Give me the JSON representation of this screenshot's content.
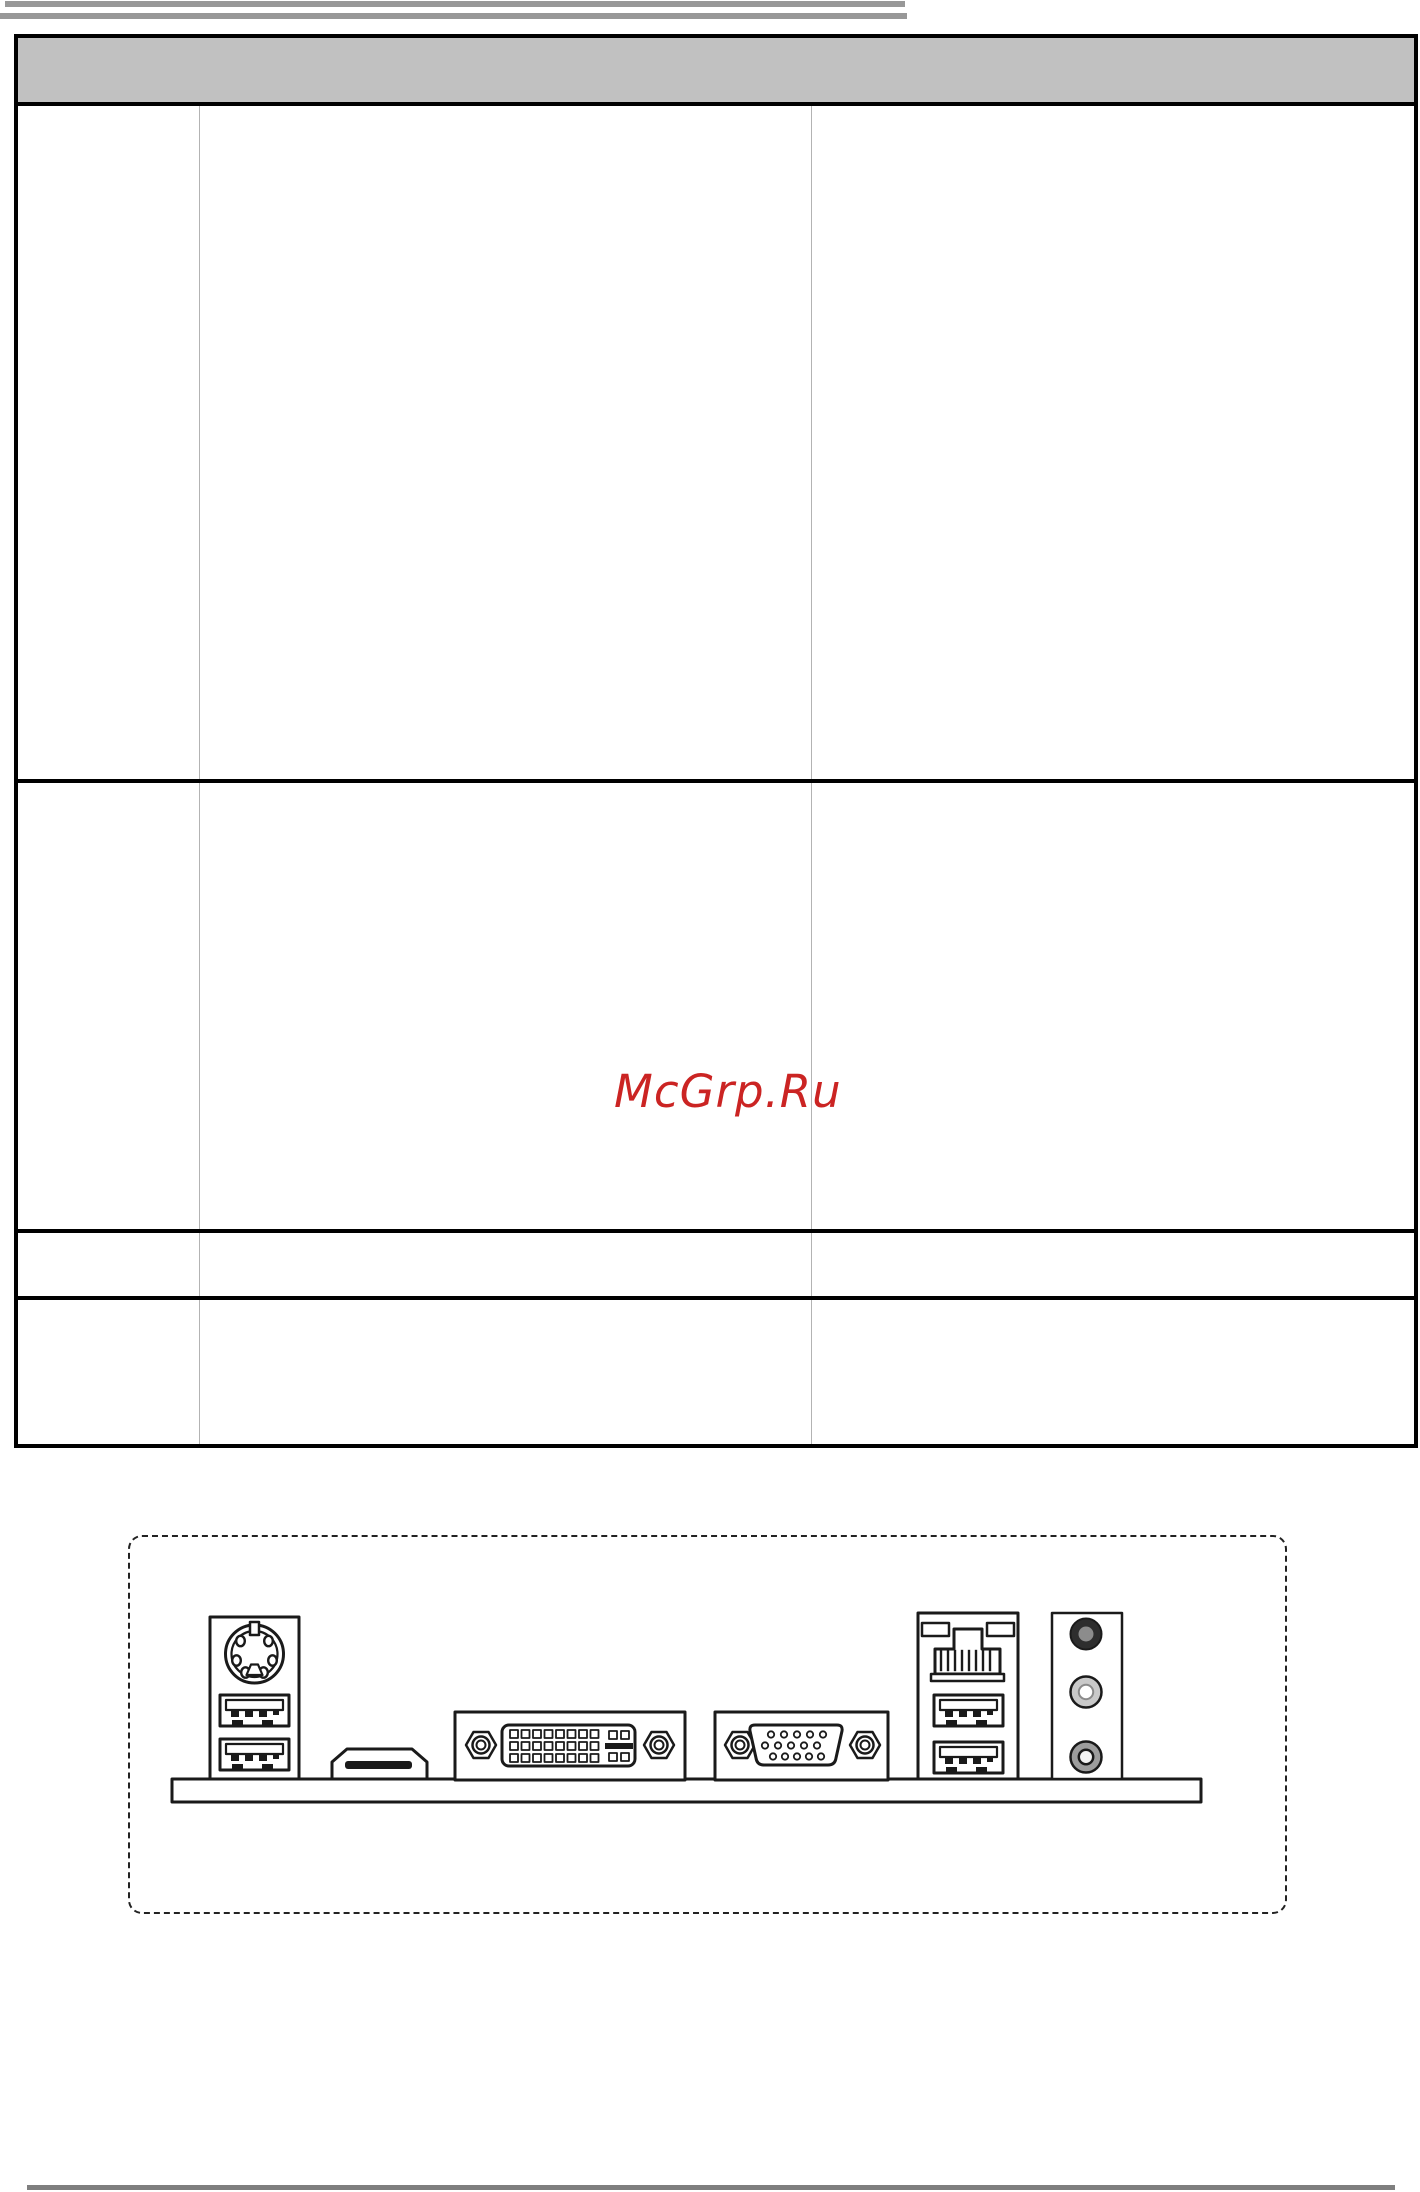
{
  "page": {
    "background": "#ffffff",
    "top_bars_color": "#989898",
    "bottom_bar_color": "#7f7f7f"
  },
  "watermark": {
    "text": "McGrp.Ru",
    "color": "#cb2423"
  },
  "spec_table": {
    "header_fill": "#c1c1c1",
    "border_color": "#000000",
    "divider_color": "#b3b3b3",
    "header_text": "",
    "columns": [
      {
        "text": ""
      },
      {
        "text": ""
      },
      {
        "text": ""
      }
    ],
    "rows": [
      {
        "cells": [
          "",
          "",
          ""
        ]
      },
      {
        "cells": [
          "",
          "",
          ""
        ]
      },
      {
        "cells": [
          "",
          "",
          ""
        ]
      },
      {
        "cells": [
          "",
          "",
          ""
        ]
      }
    ]
  },
  "io_panel_diagram": {
    "style": "dashed rounded outline, black line art on white",
    "line_color": "#1a1a1a",
    "components": [
      "ps2-port",
      "usb-port",
      "usb-port",
      "hdmi-port",
      "dvi-d-port",
      "vga-port",
      "lan-rj45-port",
      "usb-port",
      "usb-port",
      "audio-jack-dark",
      "audio-jack-light",
      "audio-jack-gray"
    ]
  }
}
